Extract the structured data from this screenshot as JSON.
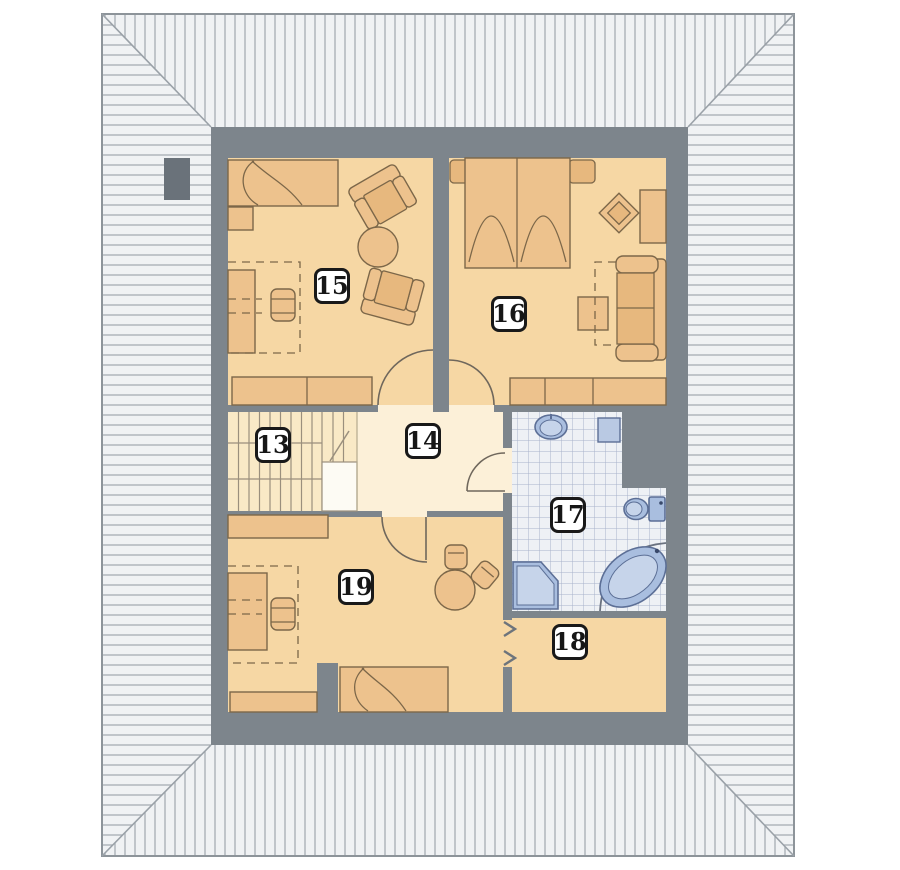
{
  "plan": {
    "kind": "attic-floor-plan",
    "rooms": [
      {
        "id": "13",
        "label": "13",
        "type": "staircase",
        "features": [
          "stairs",
          "landing",
          "break-line"
        ]
      },
      {
        "id": "14",
        "label": "14",
        "type": "hallway",
        "features": [
          "door-to-15",
          "door-to-16",
          "door-to-17",
          "door-to-19"
        ]
      },
      {
        "id": "15",
        "label": "15",
        "type": "room",
        "features": [
          "bed",
          "nightstand",
          "armchair",
          "armchair",
          "round-table",
          "desk",
          "desk-chair",
          "sofa"
        ]
      },
      {
        "id": "16",
        "label": "16",
        "type": "bedroom",
        "features": [
          "double-bed",
          "pillows",
          "diamond-side-table",
          "wardrobe",
          "sofa",
          "side-table",
          "dresser"
        ]
      },
      {
        "id": "17",
        "label": "17",
        "type": "bathroom",
        "features": [
          "washbasin",
          "washing-machine",
          "toilet",
          "corner-bathtub",
          "corner-shower",
          "floor-tiles"
        ]
      },
      {
        "id": "18",
        "label": "18",
        "type": "room",
        "features": [
          "knee-wall-access-chevrons"
        ]
      },
      {
        "id": "19",
        "label": "19",
        "type": "room",
        "features": [
          "dresser",
          "desk",
          "desk-chair",
          "round-table",
          "stool",
          "stool",
          "bed",
          "cabinet"
        ]
      }
    ],
    "exterior": {
      "roof_hatching": "hip-roof-bands",
      "chimney": "left-roof-slope"
    }
  },
  "palette": {
    "page_bg": "#ffffff",
    "roof_fill": "#f0f2f4",
    "roof_hatch_line": "#a6adb3",
    "roof_edge": "#8d949a",
    "wall_gray": "#7d858c",
    "chimney_gray": "#6a727a",
    "room_floor": "#f6d7a4",
    "hall_floor": "#fcf0d8",
    "stairs_floor": "#f9e9c6",
    "furniture_fill": "#edc28d",
    "furniture_line": "#7c6749",
    "tile_bg": "#eef1f5",
    "tile_line": "#a8b2ca",
    "fixture_fill": "#a9bedf",
    "fixture_line": "#5c6f96",
    "label_border": "#191919",
    "label_text": "#161616"
  }
}
